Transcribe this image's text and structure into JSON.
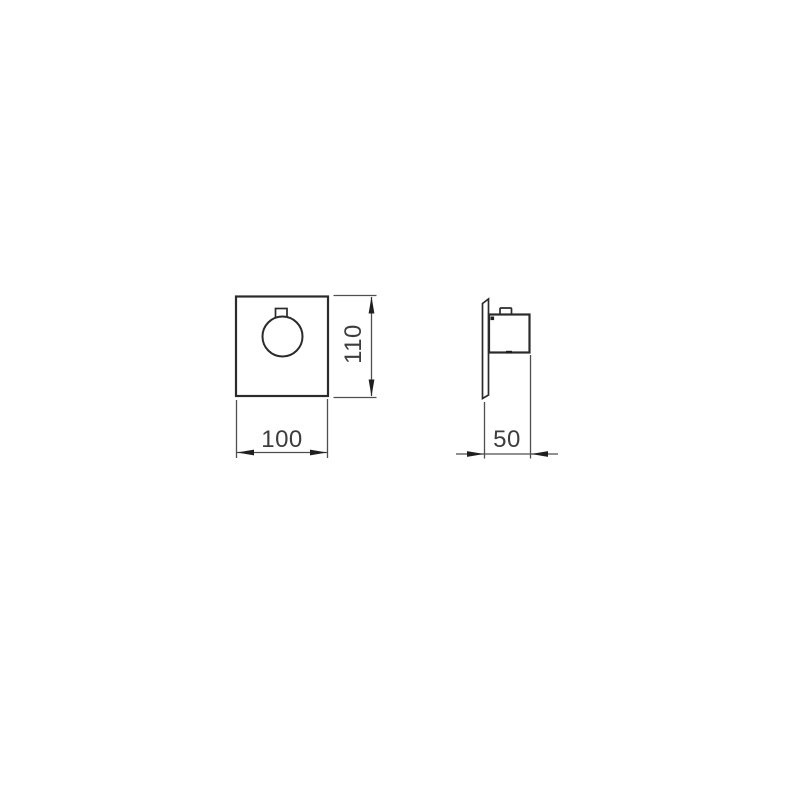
{
  "canvas": {
    "background": "#ffffff",
    "outline_color": "#2b2b2b",
    "dim_line_color": "#4f4f4f",
    "arrow_color": "#1f1f1f",
    "text_color": "#3d3d3d"
  },
  "views": {
    "front": {
      "width_label": "100",
      "height_label": "110"
    },
    "side": {
      "depth_label": "50"
    }
  }
}
